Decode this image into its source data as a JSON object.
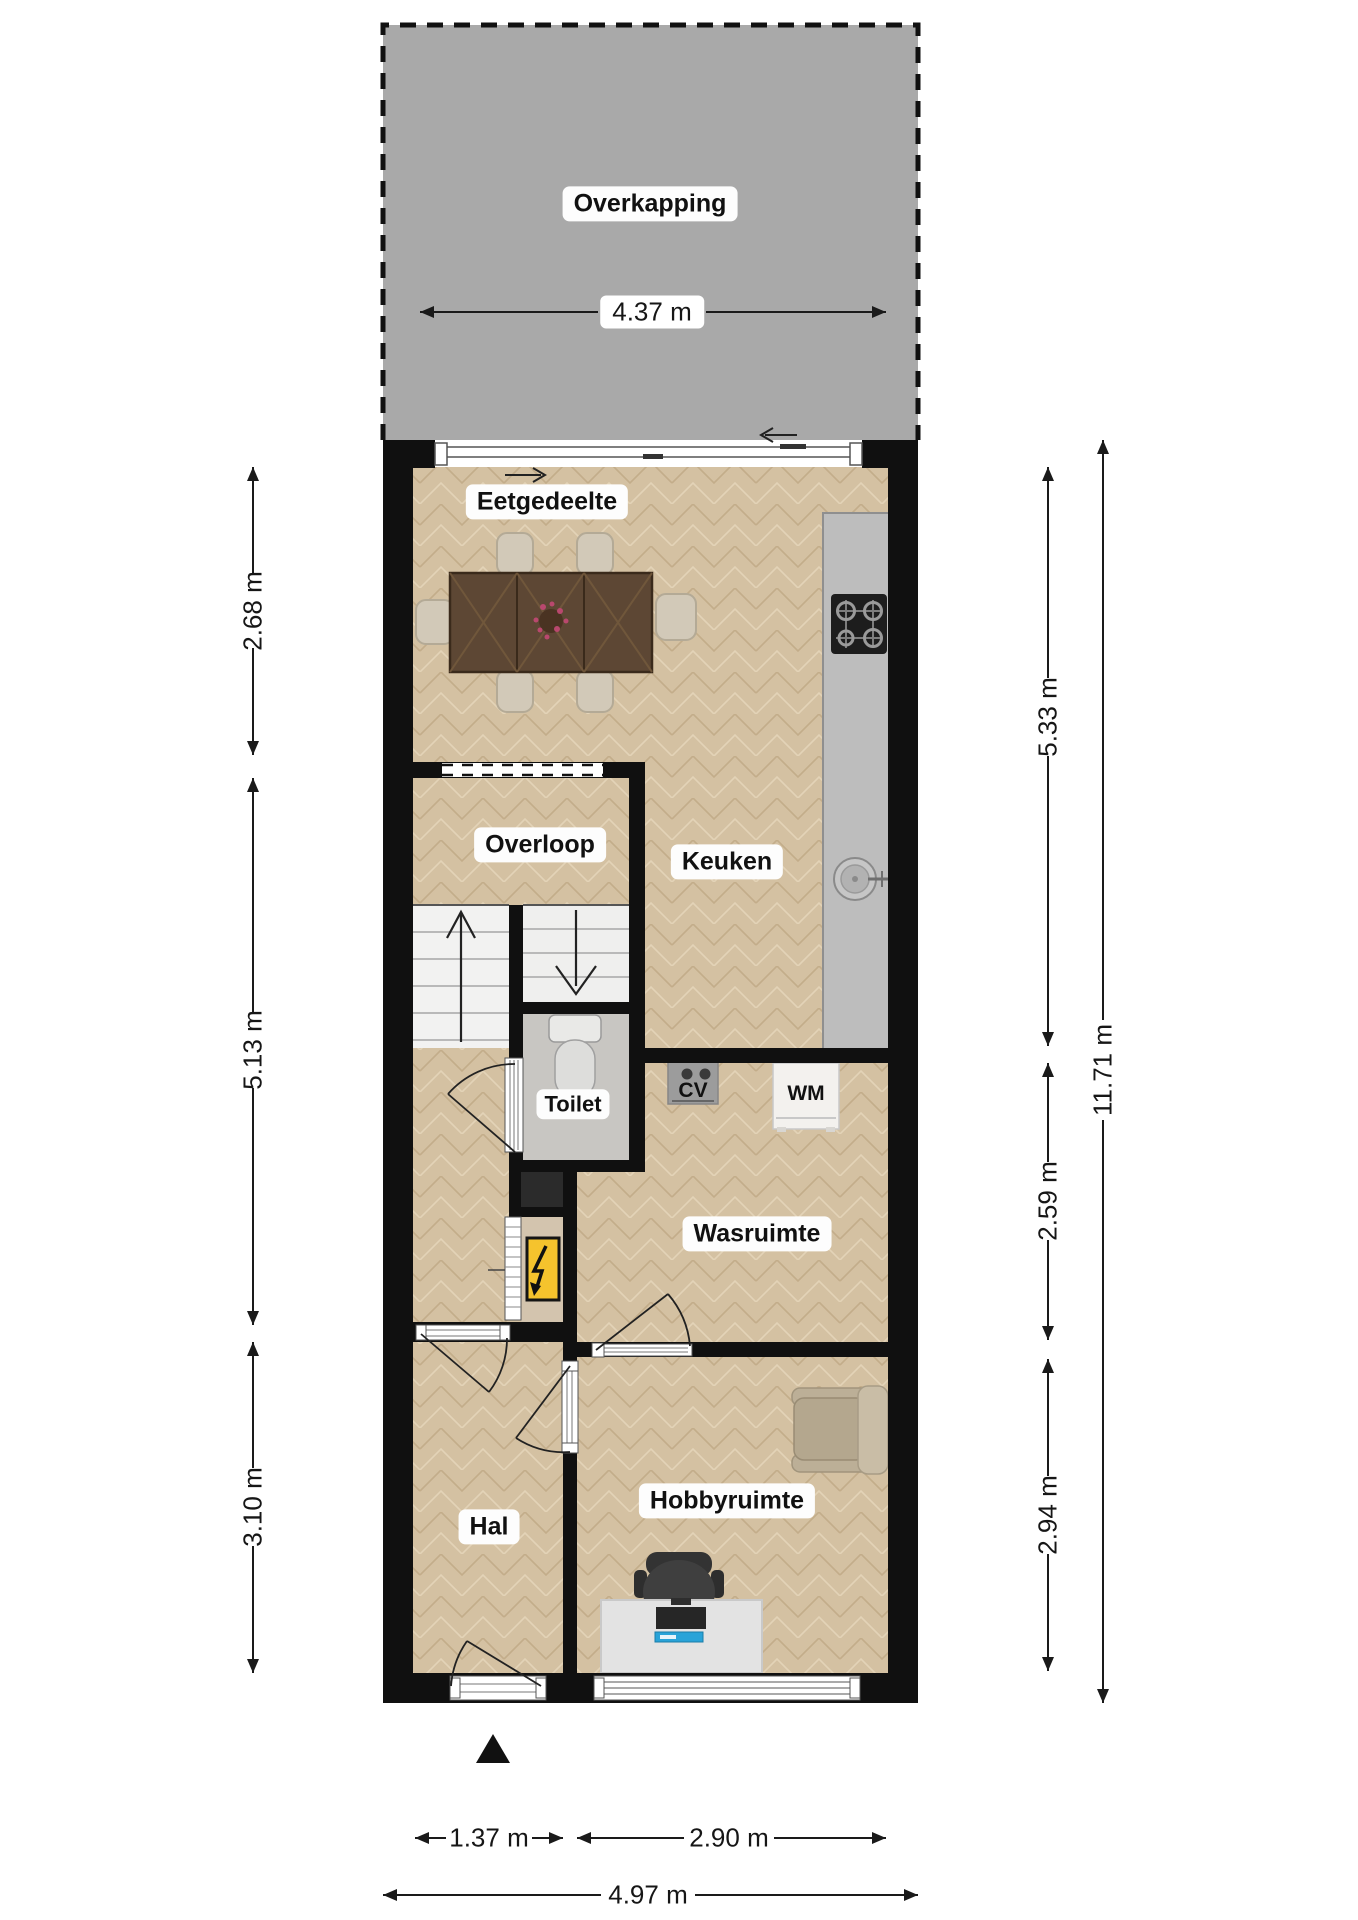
{
  "rooms": {
    "overkapping": "Overkapping",
    "eetgedeelte": "Eetgedeelte",
    "overloop": "Overloop",
    "keuken": "Keuken",
    "toilet": "Toilet",
    "wasruimte": "Wasruimte",
    "hal": "Hal",
    "hobbyruimte": "Hobbyruimte"
  },
  "appliances": {
    "cv": "CV",
    "wm": "WM"
  },
  "dimensions": {
    "overkapping_width": "4.37 m",
    "left": [
      "2.68 m",
      "5.13 m",
      "3.10 m"
    ],
    "right": [
      "5.33 m",
      "2.59 m",
      "2.94 m"
    ],
    "right_total": "11.71 m",
    "bottom": [
      "1.37 m",
      "2.90 m"
    ],
    "bottom_total": "4.97 m"
  },
  "colors": {
    "wall": "#101010",
    "floor_wood": "#d4c1a2",
    "overkapping_fill": "#a9a9a9",
    "toilet_floor": "#c8c6c2",
    "kitchen_counter": "#bdbdbd",
    "electrical_panel": "#f5c32d",
    "keyboard_blue": "#29a3d8"
  }
}
